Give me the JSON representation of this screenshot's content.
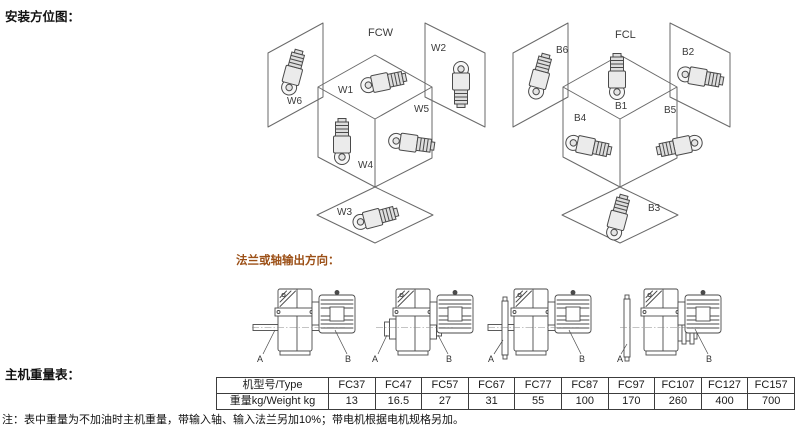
{
  "colors": {
    "accent": "#9c5017",
    "line": "#4a4a4a",
    "text": "#1a1a1a",
    "background": "#ffffff"
  },
  "headings": {
    "installation": "安装方位图：",
    "flange_output": "法兰或轴输出方向：",
    "weight_table": "主机重量表："
  },
  "mount_diagrams": {
    "fcw": {
      "title": "FCW",
      "w1": "W1",
      "w2": "W2",
      "w3": "W3",
      "w4": "W4",
      "w5": "W5",
      "w6": "W6"
    },
    "fcl": {
      "title": "FCL",
      "b1": "B1",
      "b2": "B2",
      "b3": "B3",
      "b4": "B4",
      "b5": "B5",
      "b6": "B6"
    }
  },
  "output_drawings": [
    {
      "type": "solid-shaft-both-sides",
      "a": "A",
      "b": "B"
    },
    {
      "type": "hollow-shaft-hubs",
      "a": "A",
      "b": "B"
    },
    {
      "type": "flange-with-through-shaft",
      "a": "A",
      "b": "B"
    },
    {
      "type": "flange-with-grooved-hub",
      "a": "A",
      "b": "B"
    }
  ],
  "weight_table": {
    "header_label": "机型号/Type",
    "models": [
      "FC37",
      "FC47",
      "FC57",
      "FC67",
      "FC77",
      "FC87",
      "FC97",
      "FC107",
      "FC127",
      "FC157"
    ],
    "row_label": "重量kg/Weight kg",
    "weights": [
      "13",
      "16.5",
      "27",
      "31",
      "55",
      "100",
      "170",
      "260",
      "400",
      "700"
    ]
  },
  "note": "注：表中重量为不加油时主机重量，带输入轴、输入法兰另加10%；带电机根据电机规格另加。"
}
